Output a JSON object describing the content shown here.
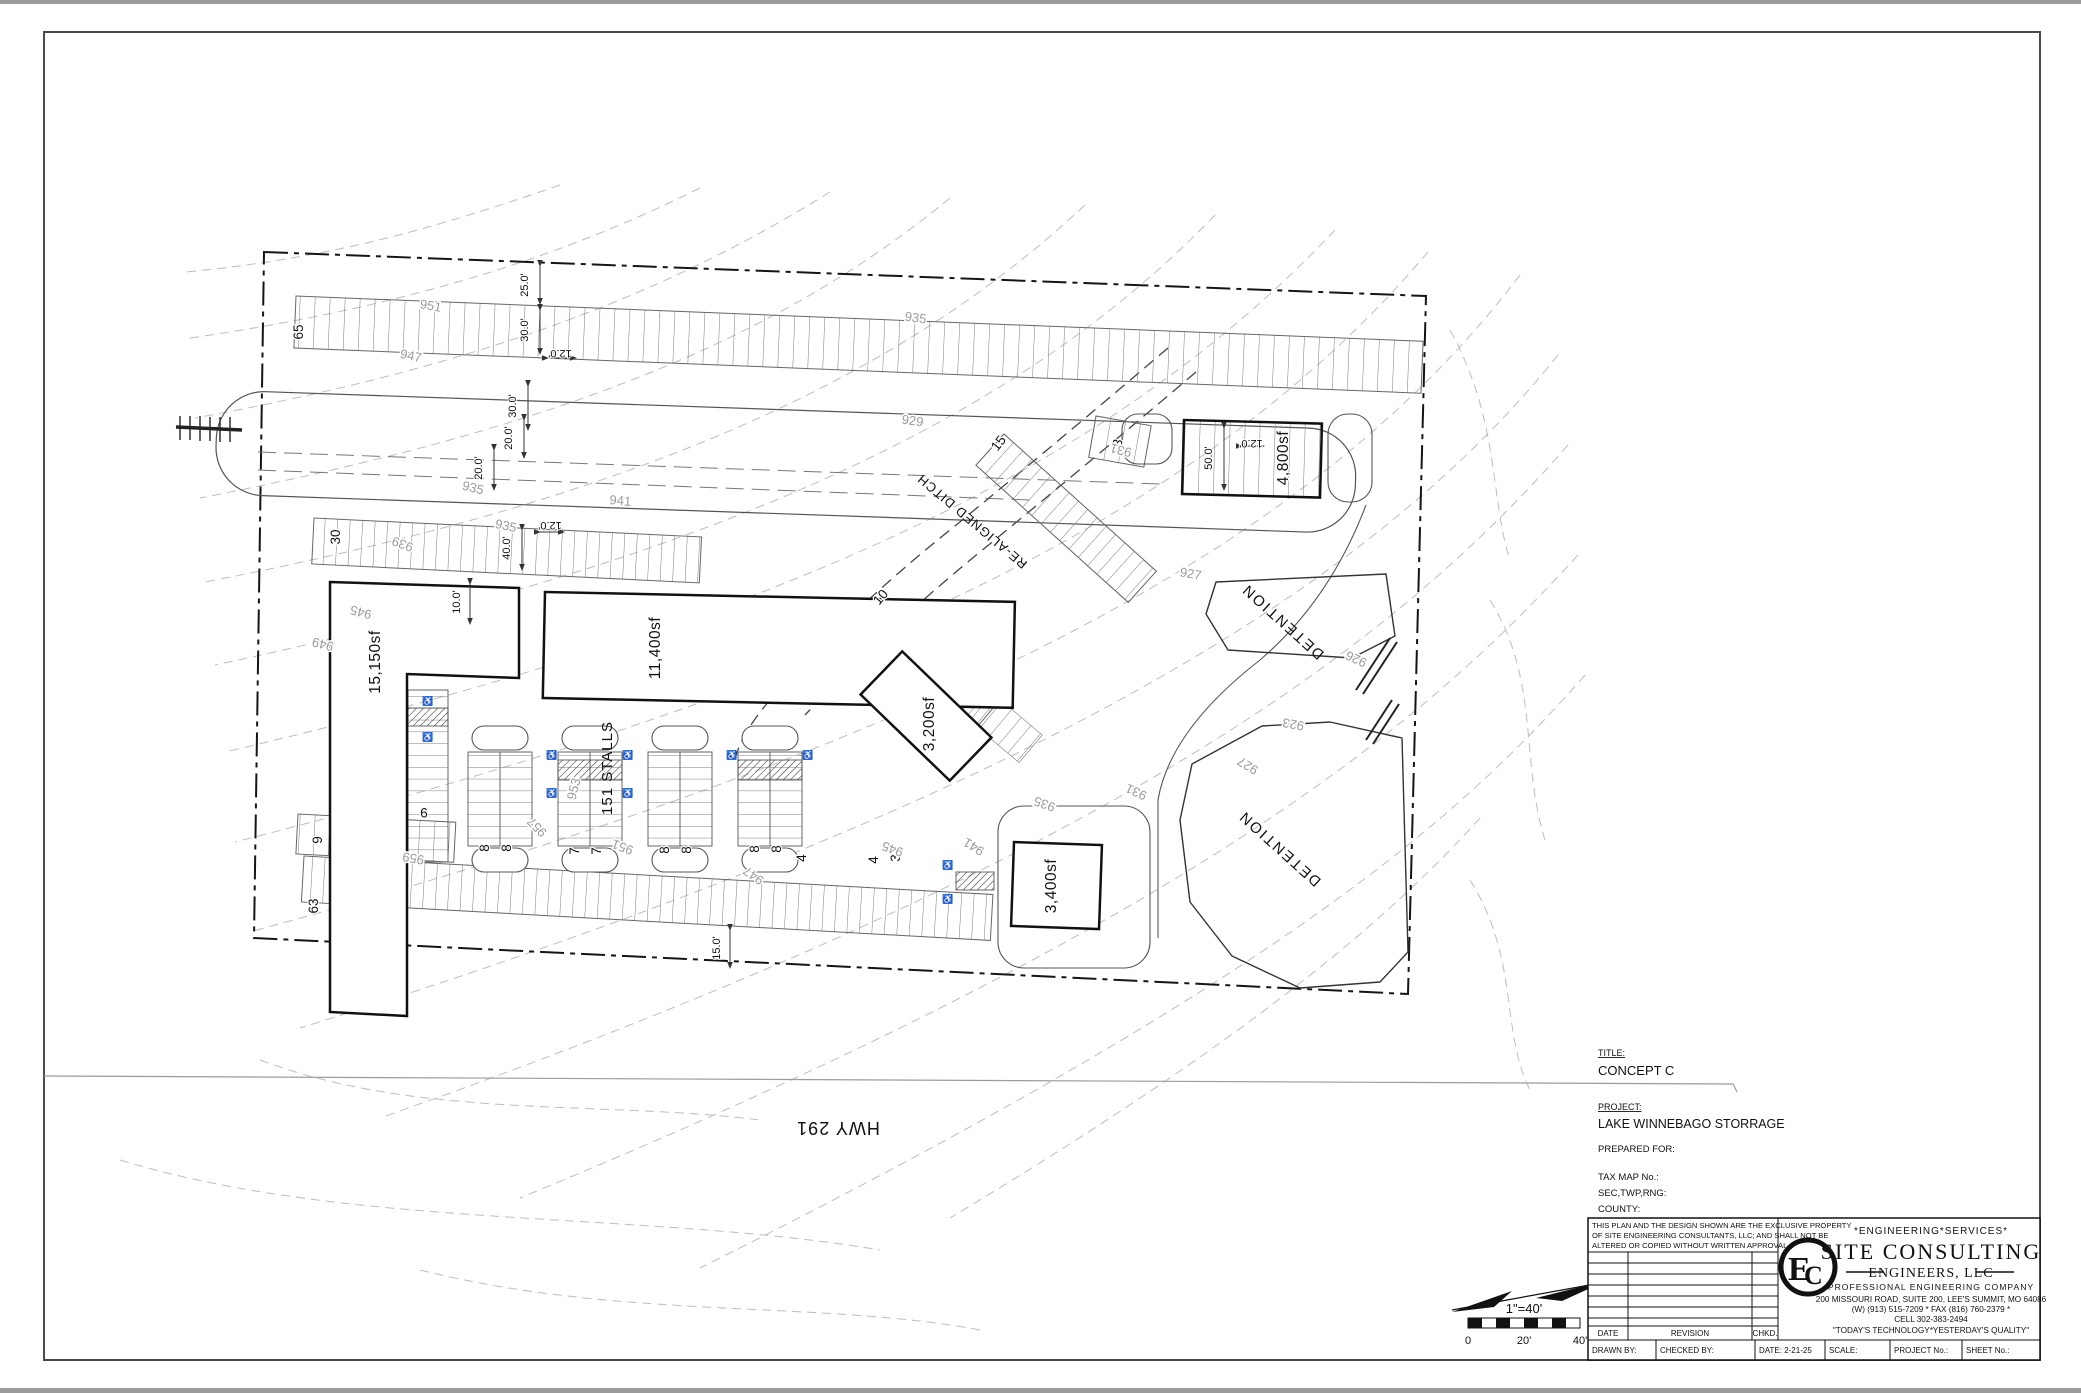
{
  "plan": {
    "highway_label": "HWY 291",
    "ditch_label": "RE-ALIGNED DITCH",
    "detention_upper_label": "DETENTION",
    "detention_lower_label": "DETENTION",
    "stalls_total_label": "151 STALLS",
    "buildings": {
      "west": "15,150sf",
      "north": "11,400sf",
      "center": "3,200sf",
      "office": "3,400sf",
      "east": "4,800sf"
    },
    "stall_counts": {
      "top_row": "65",
      "second_row": "30",
      "angled_ne_row": "15",
      "small_ne_row": "3",
      "angled_center_row": "10",
      "bottom_row": "63",
      "bottom_left_row": "9",
      "west_column": "9",
      "col1_left": "8",
      "col1_right": "8",
      "col2_left": "7",
      "col2_right": "7",
      "col3_left": "8",
      "col3_right": "8",
      "col4_left": "8",
      "col4_right": "8",
      "east_of_col4": "4",
      "office_row_a": "4",
      "office_row_b": "3"
    },
    "dimensions": {
      "aisle_25": "25.0'",
      "stall_30a": "30.0'",
      "drive_12a": "12.0'",
      "stall_30b": "30.0'",
      "lane_20a": "20.0'",
      "lane_20b": "20.0'",
      "drive_12b": "12.0'",
      "stall_40": "40.0'",
      "setback_10": "10.0'",
      "bldg_50": "50.0'",
      "bldg_12": "12.0'",
      "stall_15": "15.0'"
    },
    "contours": {
      "c1": "951",
      "c2": "947",
      "c3": "941",
      "c4": "935",
      "c5": "935",
      "c6": "939",
      "c7": "935",
      "c8": "929",
      "c9": "931",
      "c10": "927",
      "c11": "926",
      "c12": "923",
      "c13": "927",
      "c14": "931",
      "c15": "935",
      "c16": "941",
      "c17": "945",
      "c18": "945",
      "c19": "949",
      "c20": "953",
      "c21": "957",
      "c22": "951",
      "c23": "959",
      "c24": "947"
    }
  },
  "scale_bar": {
    "ratio": "1\"=40'",
    "tick0": "0",
    "tick20": "20'",
    "tick40": "40'"
  },
  "title_block": {
    "title_label": "TITLE:",
    "title": "CONCEPT C",
    "project_label": "PROJECT:",
    "project": "LAKE WINNEBAGO STORRAGE",
    "prepared_for_label": "PREPARED FOR:",
    "tax_map_label": "TAX MAP No.:",
    "sec_twp_rng_label": "SEC,TWP,RNG:",
    "county_label": "COUNTY:",
    "disclaimer_lines": [
      "THIS PLAN AND THE DESIGN SHOWN ARE THE EXCLUSIVE PROPERTY",
      "OF SITE ENGINEERING CONSULTANTS, LLC; AND SHALL NOT BE",
      "ALTERED OR COPIED WITHOUT WRITTEN APPROVAL."
    ],
    "revision_headers": {
      "date": "DATE",
      "revision": "REVISION",
      "chkd": "CHKD."
    },
    "company": {
      "tagline_top": "*ENGINEERING*SERVICES*",
      "name": "SITE CONSULTING",
      "subname": "ENGINEERS, LLC",
      "type_line": "PROFESSIONAL ENGINEERING COMPANY",
      "address": "200 MISSOURI ROAD, SUITE 200, LEE'S SUMMIT, MO 64086",
      "phone": "(W) (913) 515-7209 * FAX (816) 760-2379 *",
      "cell": "CELL 302-383-2494",
      "motto": "\"TODAY'S TECHNOLOGY*YESTERDAY'S QUALITY\"",
      "logo_letter_e": "E",
      "logo_letter_c": "C"
    },
    "bottom_row": {
      "drawn_by": "DRAWN BY:",
      "checked_by": "CHECKED BY:",
      "date": "DATE: 2-21-25",
      "scale": "SCALE:",
      "project_no": "PROJECT No.:",
      "sheet_no": "SHEET No.:"
    }
  }
}
